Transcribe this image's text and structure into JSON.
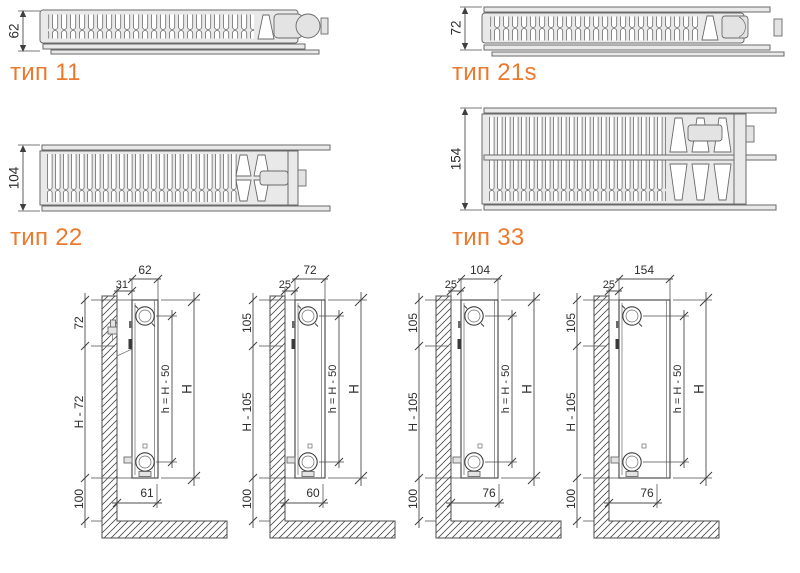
{
  "colors": {
    "accent_orange": "#EB7A2E",
    "drawing_line": "#4d4d4d",
    "body_fill": "#e9e9e9"
  },
  "cross_sections": [
    {
      "type_label": "тип 11",
      "depth_mm": "62"
    },
    {
      "type_label": "тип 21s",
      "depth_mm": "72"
    },
    {
      "type_label": "тип 22",
      "depth_mm": "104"
    },
    {
      "type_label": "тип 33",
      "depth_mm": "154"
    }
  ],
  "mounting_diagrams": [
    {
      "depth": "62",
      "wall_gap": "31",
      "top_offset": "72",
      "panel_span": "H - 72",
      "floor_clearance": "100",
      "connection_span": "h = H - 50",
      "height": "H",
      "bottom_offset": "61"
    },
    {
      "depth": "72",
      "wall_gap": "25",
      "top_offset": "105",
      "panel_span": "H - 105",
      "floor_clearance": "100",
      "connection_span": "h = H - 50",
      "height": "H",
      "bottom_offset": "60"
    },
    {
      "depth": "104",
      "wall_gap": "25",
      "top_offset": "105",
      "panel_span": "H - 105",
      "floor_clearance": "100",
      "connection_span": "h = H - 50",
      "height": "H",
      "bottom_offset": "76"
    },
    {
      "depth": "154",
      "wall_gap": "25",
      "top_offset": "105",
      "panel_span": "H - 105",
      "floor_clearance": "100",
      "connection_span": "h = H - 50",
      "height": "H",
      "bottom_offset": "76"
    }
  ]
}
